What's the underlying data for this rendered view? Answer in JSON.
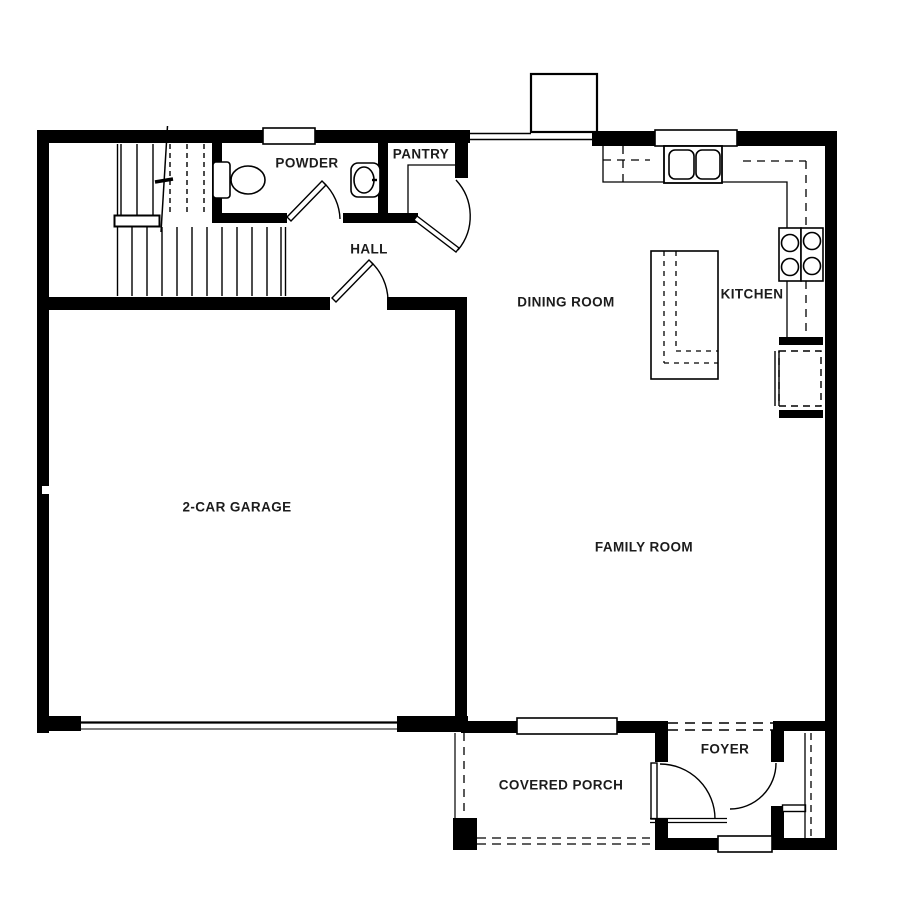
{
  "floor_plan": {
    "rooms": {
      "powder": "POWDER",
      "pantry": "PANTRY",
      "hall": "HALL",
      "dining_room": "DINING ROOM",
      "kitchen": "KITCHEN",
      "garage": "2-CAR GARAGE",
      "family_room": "FAMILY ROOM",
      "foyer": "FOYER",
      "covered_porch": "COVERED PORCH"
    },
    "colors": {
      "walls": "#000000",
      "background": "#ffffff",
      "label_text": "#1c1c1c"
    }
  }
}
